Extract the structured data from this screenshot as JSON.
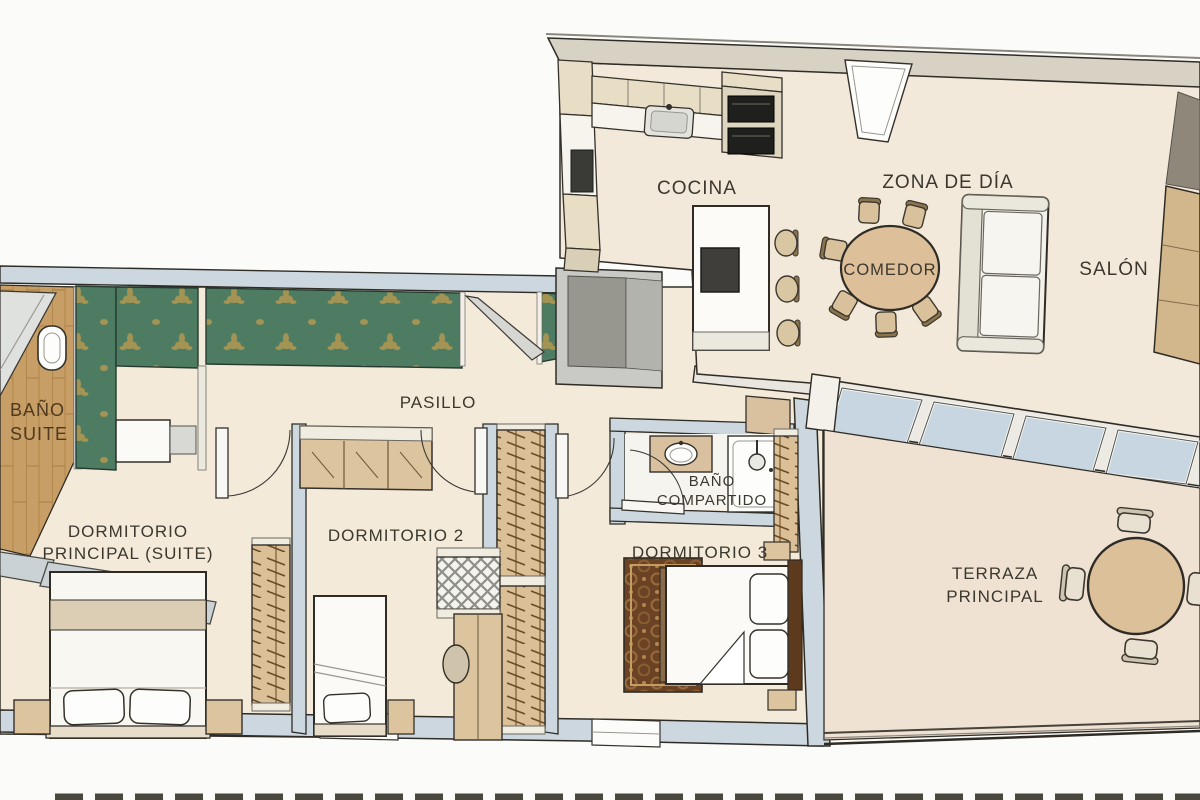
{
  "labels": {
    "cocina": "COCINA",
    "zona_de_dia": "ZONA DE DÍA",
    "comedor": "COMEDOR",
    "salon": "SALÓN",
    "pasillo": "PASILLO",
    "bano_suite_l1": "BAÑO",
    "bano_suite_l2": "SUITE",
    "dormitorio_principal_l1": "DORMITORIO",
    "dormitorio_principal_l2": "PRINCIPAL (SUITE)",
    "dormitorio_2": "DORMITORIO 2",
    "bano_compartido_l1": "BAÑO",
    "bano_compartido_l2": "COMPARTIDO",
    "dormitorio_3": "DORMITORIO 3",
    "terraza_l1": "TERRAZA",
    "terraza_l2": "PRINCIPAL"
  },
  "palette": {
    "background": "#fbfbf9",
    "floor_cream": "#f4ead9",
    "floor_living": "#f3e9da",
    "floor_terrace": "#f0e2d3",
    "wall_blue_gray": "#ccd7df",
    "wall_tan": "#d8d2c5",
    "wallpaper_green": "#4d7c63",
    "wallpaper_gold": "#b99a4e",
    "wood_floor": "#c79e66",
    "furniture_tan": "#dcc49e",
    "glass_blue": "#c7d6e1",
    "outline_dark": "#2f2c26",
    "label_color": "#3b382f",
    "label_wood_color": "#4f3a20"
  }
}
